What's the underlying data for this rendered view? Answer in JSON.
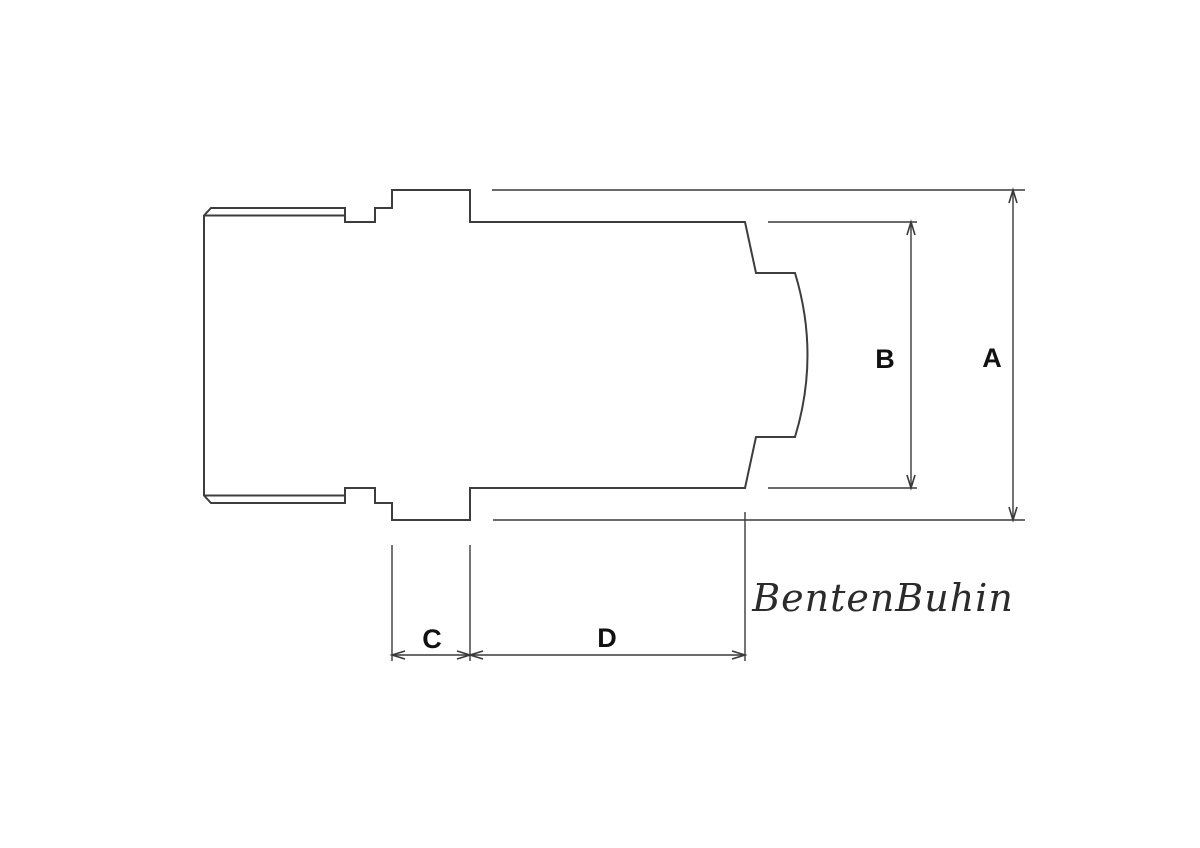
{
  "drawing": {
    "type": "technical-drawing",
    "subject": "socket-adapter-side-view",
    "dimension_labels": {
      "a": "A",
      "b": "B",
      "c": "C",
      "d": "D"
    },
    "watermark": "BentenBuhin",
    "colors": {
      "background": "#ffffff",
      "part_line": "#3d3d3d",
      "dimension_line": "#3a3a3a",
      "label_text": "#111111",
      "watermark_text": "#2b2b2b"
    }
  }
}
